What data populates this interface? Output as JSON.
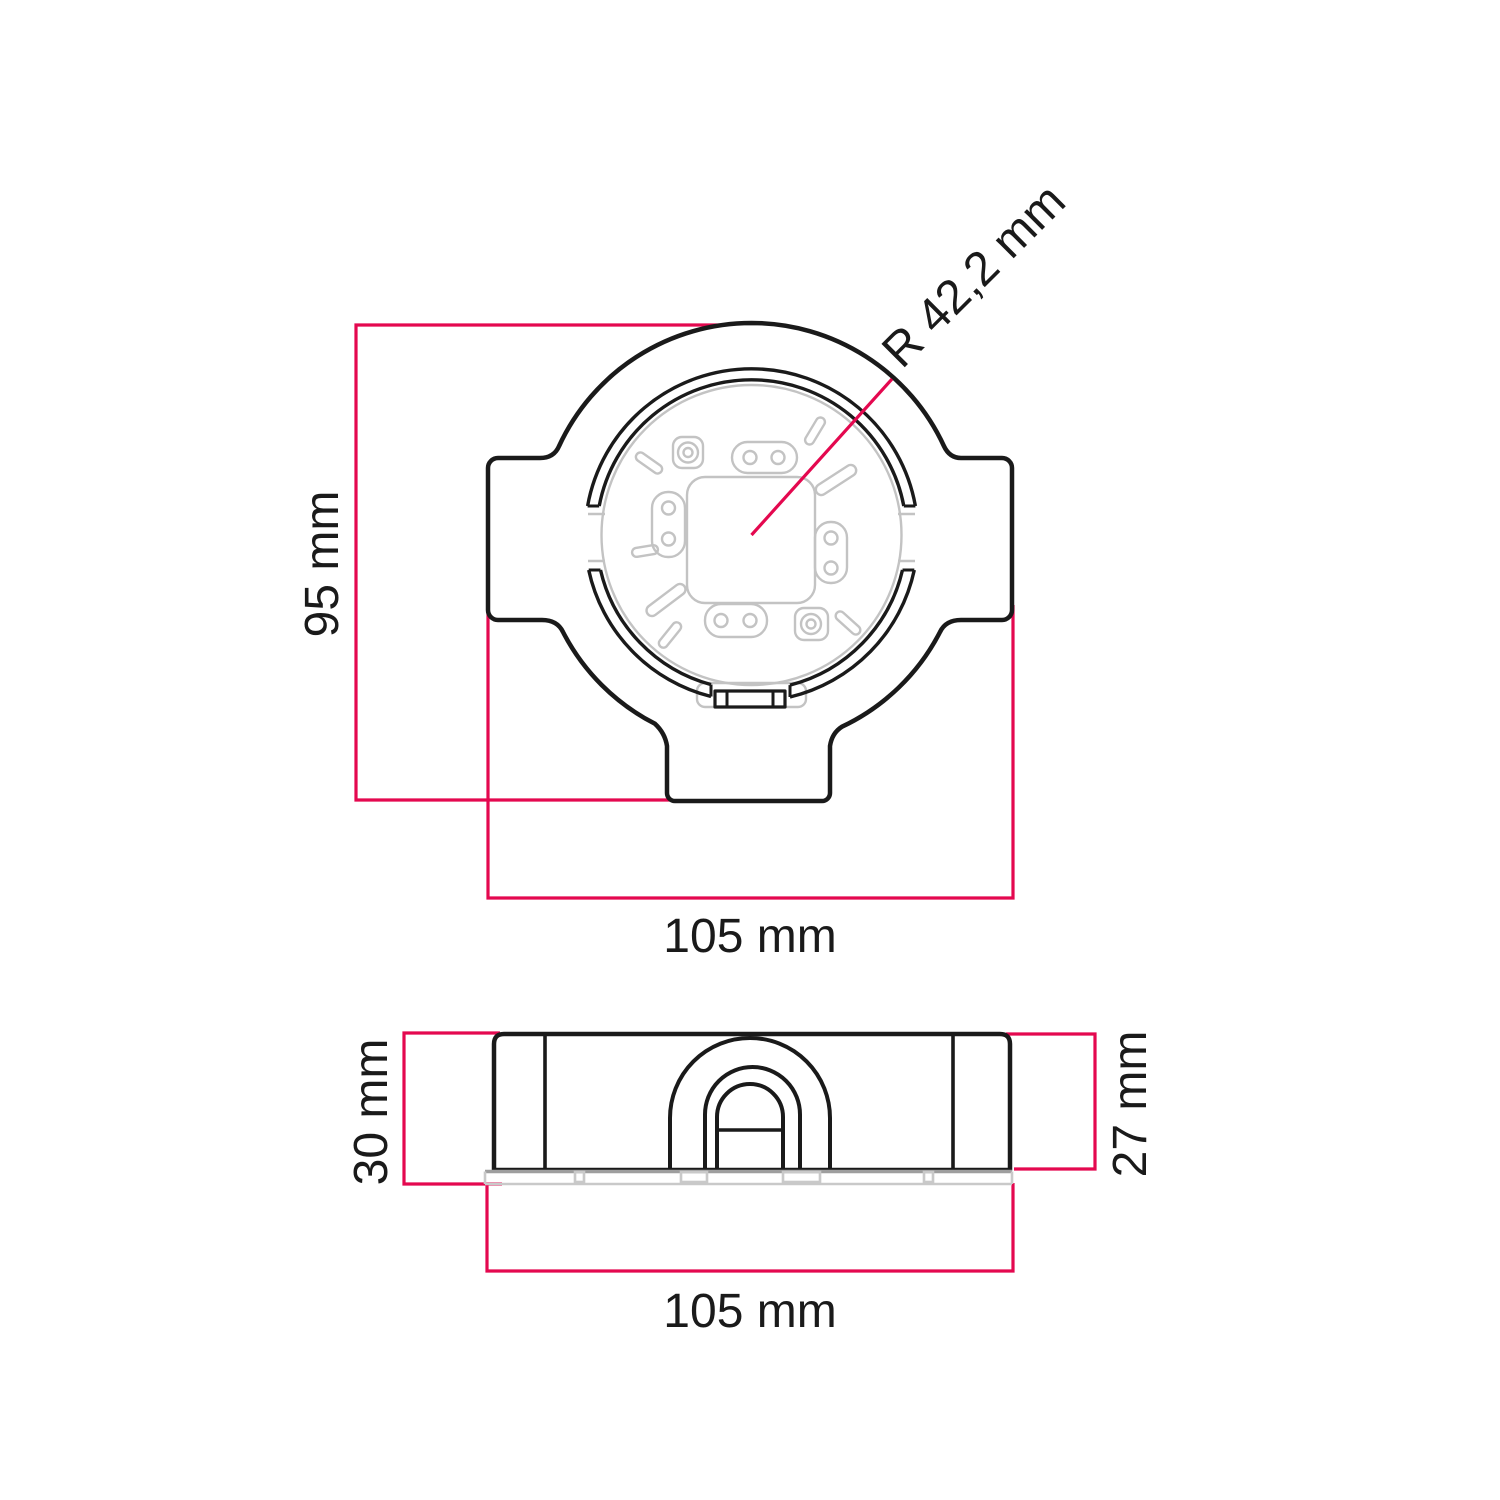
{
  "drawing": {
    "type": "technical-dimension-drawing",
    "part": "round-junction-box",
    "views": [
      "top-view",
      "side-view"
    ]
  },
  "labels": {
    "top_view": {
      "height": "95 mm",
      "width": "105 mm",
      "radius": "R 42,2 mm"
    },
    "side_view": {
      "total_height": "30 mm",
      "body_height": "27 mm",
      "width": "105 mm"
    }
  },
  "colors": {
    "dimension_accent": "#e4084f",
    "outline_black": "#1a1a1a",
    "detail_gray": "#c3c3c3",
    "base_gray": "#9e9e9e",
    "background": "#ffffff"
  }
}
